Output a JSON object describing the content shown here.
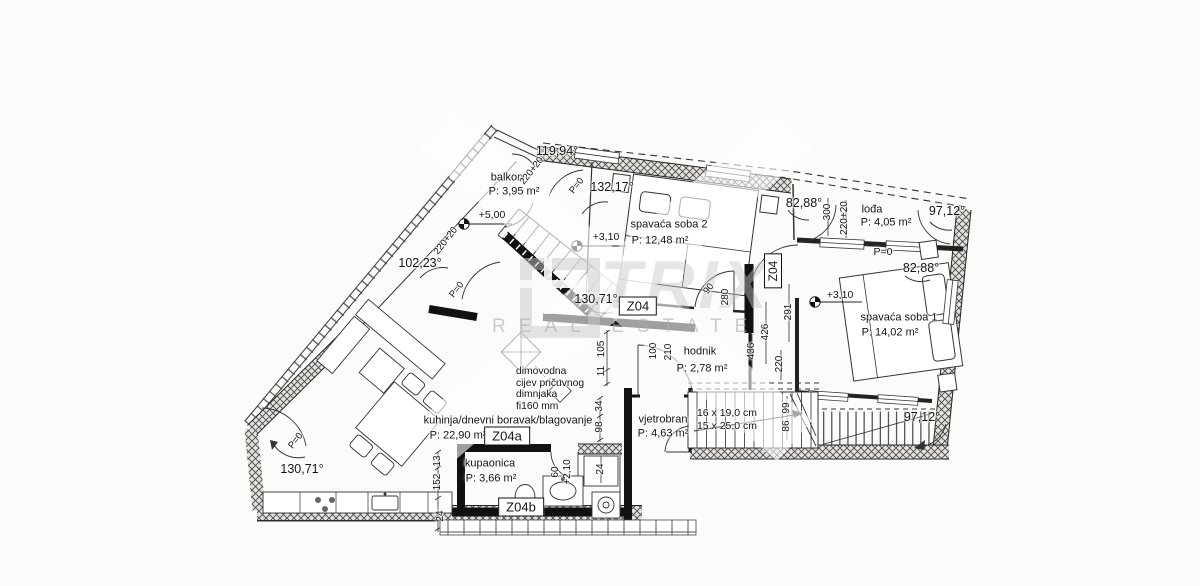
{
  "watermark": {
    "brand": "TRIX",
    "tagline": "REAL ESTATE"
  },
  "unit_labels": {
    "main": "Z04",
    "side": "Z04",
    "kitchen_zone": "Z04a",
    "bath_zone": "Z04b"
  },
  "rooms": {
    "balkon": {
      "name": "balkon",
      "area": "P: 3,95 m²"
    },
    "spavaca_soba_2": {
      "name": "spavaća soba 2",
      "area": "P: 12,48 m²"
    },
    "loda": {
      "name": "lođa",
      "area": "P: 4,05 m²"
    },
    "spavaca_soba_1": {
      "name": "spavaća soba 1",
      "area": "P: 14,02 m²"
    },
    "hodnik": {
      "name": "hodnik",
      "area": "P: 2,78 m²"
    },
    "kuhinja": {
      "name": "kuhinja/dnevni boravak/blagovanje",
      "area": "P: 22,90 m²"
    },
    "vjetrobran": {
      "name": "vjetrobran",
      "area": "P: 4,63 m²"
    },
    "kupaonica": {
      "name": "kupaonica",
      "area": "P: 3,66 m²"
    }
  },
  "angles": {
    "top_apex": "119,94°",
    "soba2_top": "132,17°",
    "balkon_left": "102,23°",
    "loda_left": "82,88°",
    "loda_right": "97,12°",
    "soba1_top": "82,88°",
    "center": "130,71°",
    "kitchen_left": "130,71°",
    "soba1_bottom": "97,12°"
  },
  "levels": {
    "balkon": "+5,00",
    "soba2": "+3,10",
    "soba1": "+3,10",
    "loda": "P=0",
    "balkon_door": "P=0",
    "terrace": "P=0",
    "kitchen": "P=0",
    "bath_door_height": "+2,10"
  },
  "stairs": {
    "line1": "16 x 19,0 cm",
    "line2": "15 x 25,0 cm"
  },
  "chimney_note": {
    "line1": "dimovodna",
    "line2": "cijev pričuvnog",
    "line3": "dimnjaka",
    "line4": "fi160 mm"
  },
  "dimensions": {
    "d300": "300",
    "d220_20_a": "220+20",
    "d220_20_b": "220+20",
    "d220_20_c": "220+20",
    "d291": "291",
    "d426": "426",
    "d436": "436",
    "d220": "220",
    "d280": "280",
    "d90": "90",
    "d100": "100",
    "d210": "210",
    "d105": "105",
    "d11": "11",
    "d34": "34",
    "d98": "98",
    "d13": "13",
    "d152": "152",
    "d24_a": "24",
    "d24_b": "24",
    "d99": "99",
    "d86": "86",
    "d60": "60"
  }
}
